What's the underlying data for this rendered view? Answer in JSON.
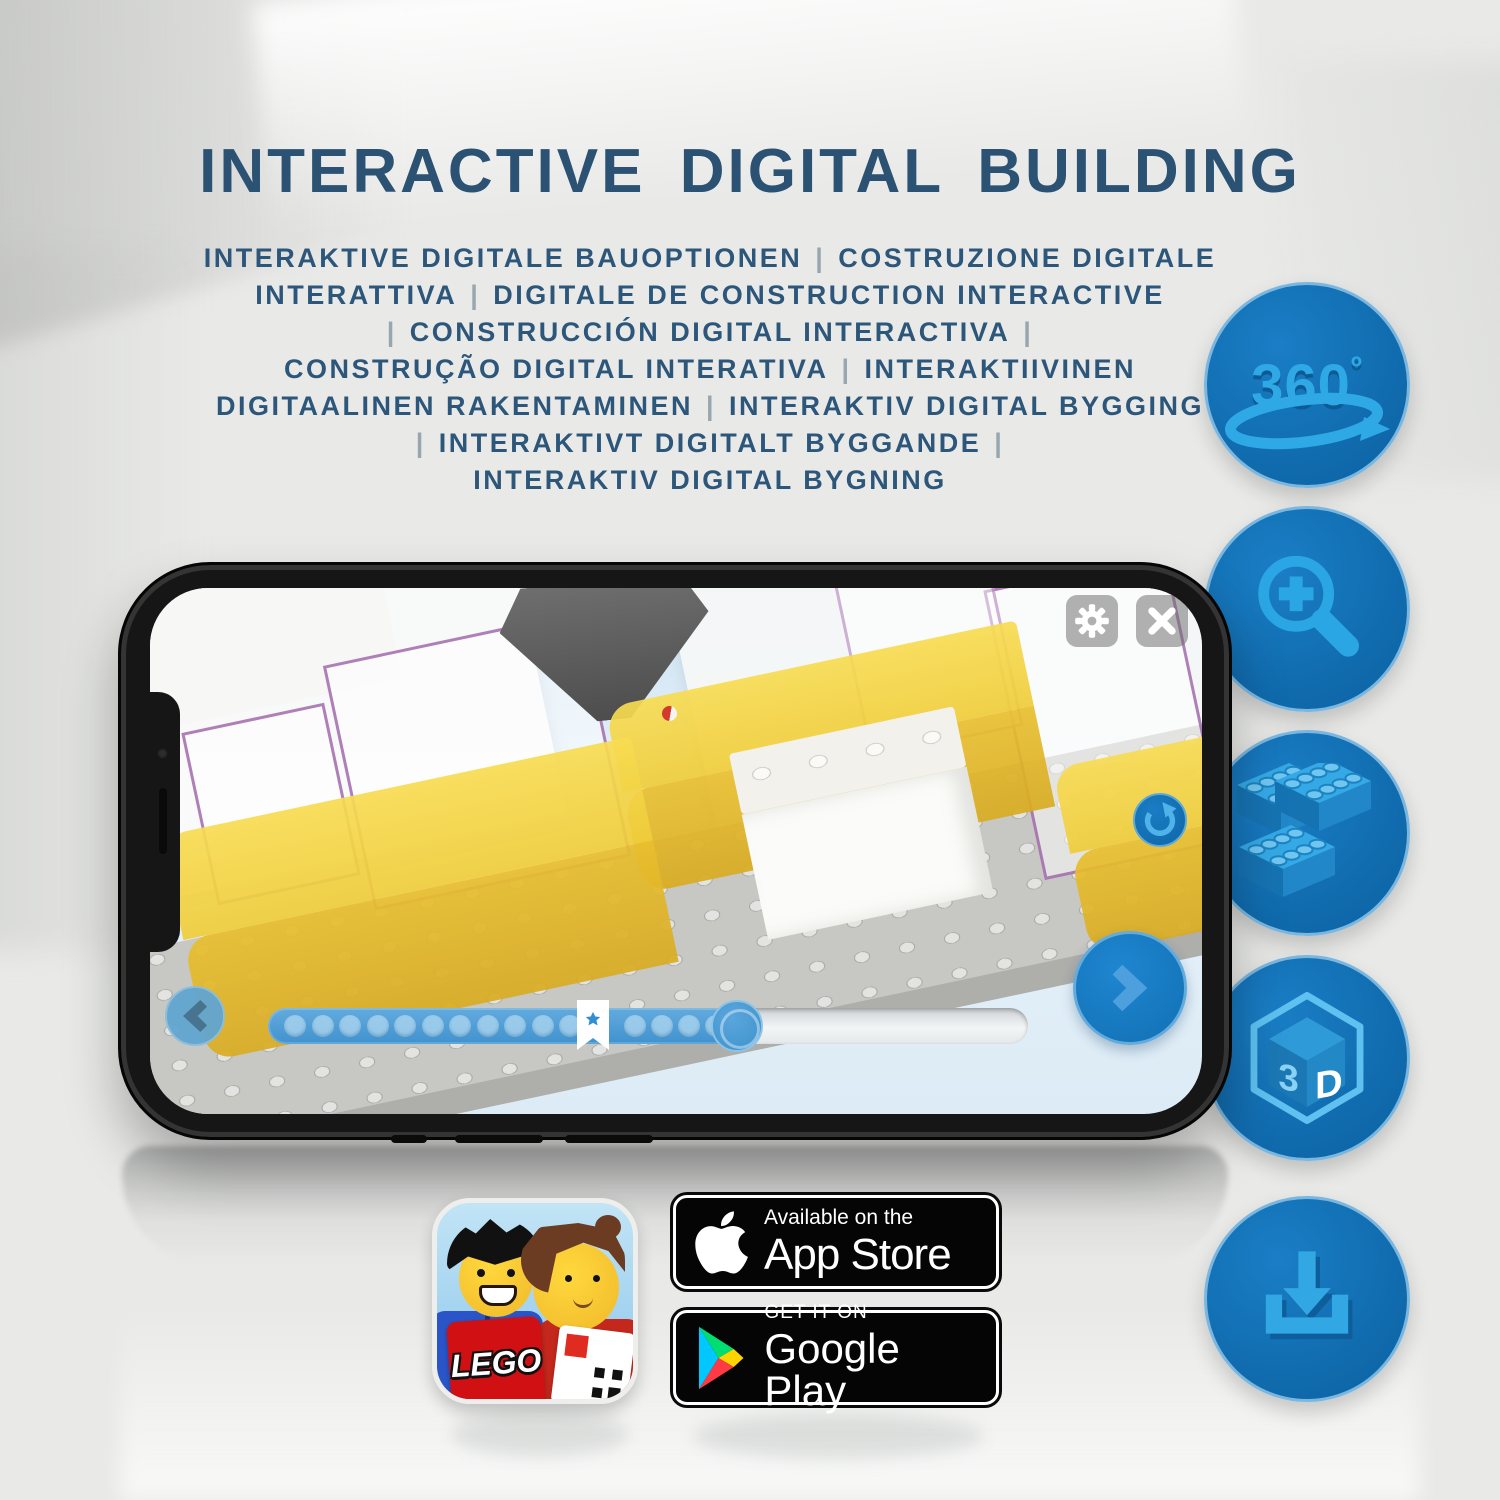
{
  "header": {
    "title": "INTERACTIVE DIGITAL BUILDING",
    "subtitle_lines": [
      "INTERAKTIVE DIGITALE BAUOPTIONEN | COSTRUZIONE DIGITALE",
      "INTERATTIVA | DIGITALE DE CONSTRUCTION INTERACTIVE",
      "| CONSTRUCCIÓN DIGITAL INTERACTIVA |",
      "CONSTRUÇÃO DIGITAL INTERATIVA | INTERAKTIIVINEN",
      "DIGITAALINEN RAKENTAMINEN | INTERAKTIV DIGITAL BYGGING",
      "| INTERAKTIVT DIGITALT BYGGANDE |",
      "INTERAKTIV DIGITAL BYGNING"
    ]
  },
  "feature_icons": [
    {
      "id": "rotation-360",
      "label": "360",
      "degree": "º"
    },
    {
      "id": "zoom-in-magnifier"
    },
    {
      "id": "building-steps-bricks"
    },
    {
      "id": "cube-3d",
      "face_left": "3",
      "face_right": "D"
    },
    {
      "id": "download"
    }
  ],
  "phone": {
    "screen": {
      "toolbar_icons": [
        "settings-gear",
        "close-x"
      ],
      "rotate_icon": "rotate-arrow",
      "nav_icons": {
        "back": "chevron-left",
        "next": "chevron-right"
      },
      "slider": {
        "steps_before_star": 11,
        "steps_after_star": 4,
        "marker": "bookmark-star",
        "progress_pct": 62
      }
    }
  },
  "store_badges": {
    "app_store": {
      "tagline": "Available on the",
      "name": "App Store"
    },
    "google_play": {
      "tagline": "GET IT ON",
      "name": "Google Play"
    },
    "app_icon_brand": "LEGO"
  },
  "colors": {
    "title_blue": "#2b5173",
    "feature_circle_blue": "#1173b9",
    "icon_glyph_blue": "#29a3e0",
    "app_ui_blue": "#1878c4",
    "brick_yellow": "#f2cd3b",
    "badge_black": "#050505"
  }
}
